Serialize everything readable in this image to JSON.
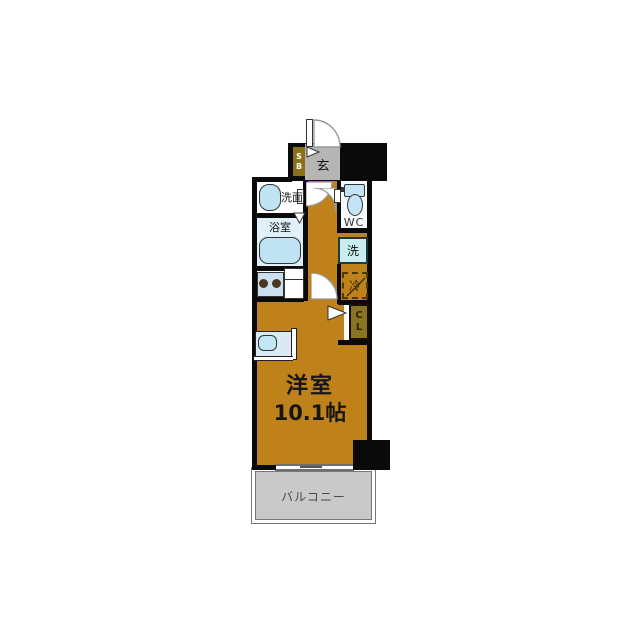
{
  "floor_plan": {
    "unit_label": {
      "room": "洋室",
      "size": "10.1帖"
    },
    "balcony_label": "バルコニー",
    "entrance_label": "玄",
    "shoe_box": {
      "l1": "S",
      "l2": "B"
    },
    "washroom_label": "洗面",
    "bathroom_label": "浴室",
    "wc_label": "WC",
    "laundry_label": "洗",
    "fridge_label": "冷",
    "closet": {
      "l1": "C",
      "l2": "L"
    }
  },
  "colors": {
    "floor_orange": "#bf811a",
    "balcony_gray": "#c9c9c9",
    "entrance_gray": "#b5b5b5",
    "shoebox_olive": "#8a7118",
    "closet_olive": "#8a7423",
    "bath_blue": "#dff0f8",
    "fixture_blue": "#bfe3f2",
    "laundry_cyan": "#c9edf1",
    "stove_blue": "#ccdff0",
    "wc_white": "#f7fafc",
    "bed_blue": "#d9eaf5",
    "wall_black": "#0a0a0a"
  }
}
